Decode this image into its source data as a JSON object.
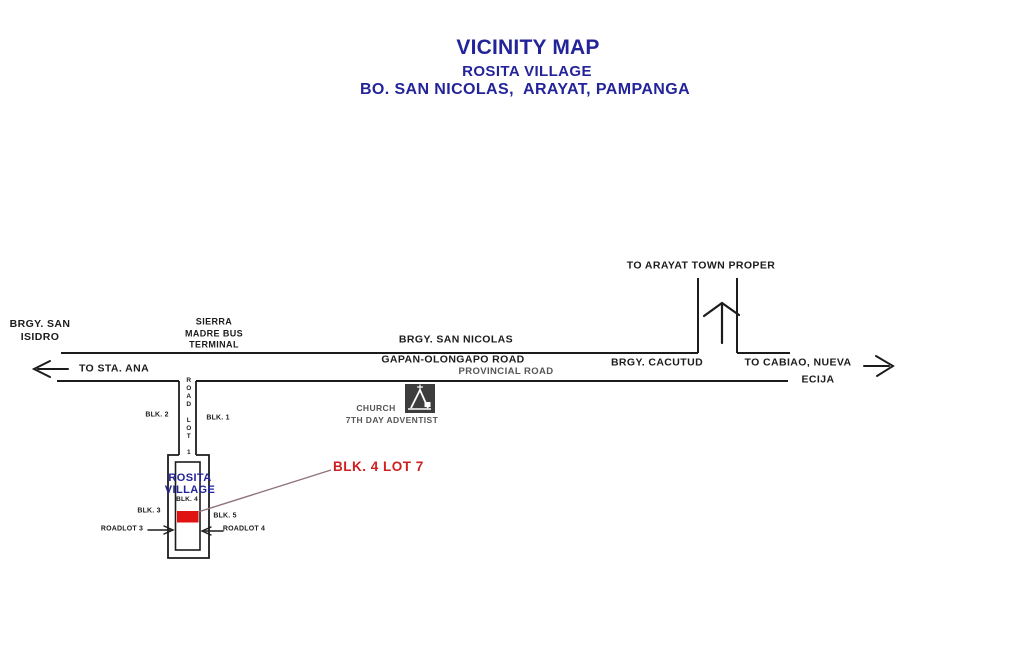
{
  "title": {
    "line1": "VICINITY MAP",
    "line2": "ROSITA VILLAGE",
    "line3": "BO. SAN NICOLAS,  ARAYAT, PAMPANGA"
  },
  "map": {
    "destinations": {
      "arayat": "TO ARAYAT TOWN PROPER",
      "sta_ana": "TO STA. ANA",
      "cabiao_line1": "TO CABIAO, NUEVA",
      "cabiao_line2": "ECIJA"
    },
    "places": {
      "brgy_san_isidro": "BRGY. SAN\nISIDRO",
      "sierra_madre_terminal": "SIERRA\nMADRE BUS\nTERMINAL",
      "brgy_san_nicolas": "BRGY. SAN NICOLAS",
      "brgy_cacutud": "BRGY. CACUTUD",
      "church_line1": "CHURCH",
      "church_line2": "7TH DAY ADVENTIST"
    },
    "roads": {
      "gapan_olongapo": "GAPAN-OLONGAPO ROAD",
      "provincial": "PROVINCIAL ROAD",
      "road_lot_1": "ROAD LOT 1"
    },
    "village": {
      "name": "ROSITA\nVILLAGE",
      "blk_1": "BLK. 1",
      "blk_2": "BLK. 2",
      "blk_3": "BLK. 3",
      "blk_4": "BLK. 4",
      "blk_5": "BLK. 5",
      "roadlot_3": "ROADLOT 3",
      "roadlot_4": "ROADLOT 4",
      "highlight": "BLK. 4 LOT 7"
    },
    "colors": {
      "title_navy": "#23239a",
      "highlight_red": "#cf1f1f",
      "lot_fill_red": "#e11212",
      "line_black": "#1c1c1c"
    }
  }
}
